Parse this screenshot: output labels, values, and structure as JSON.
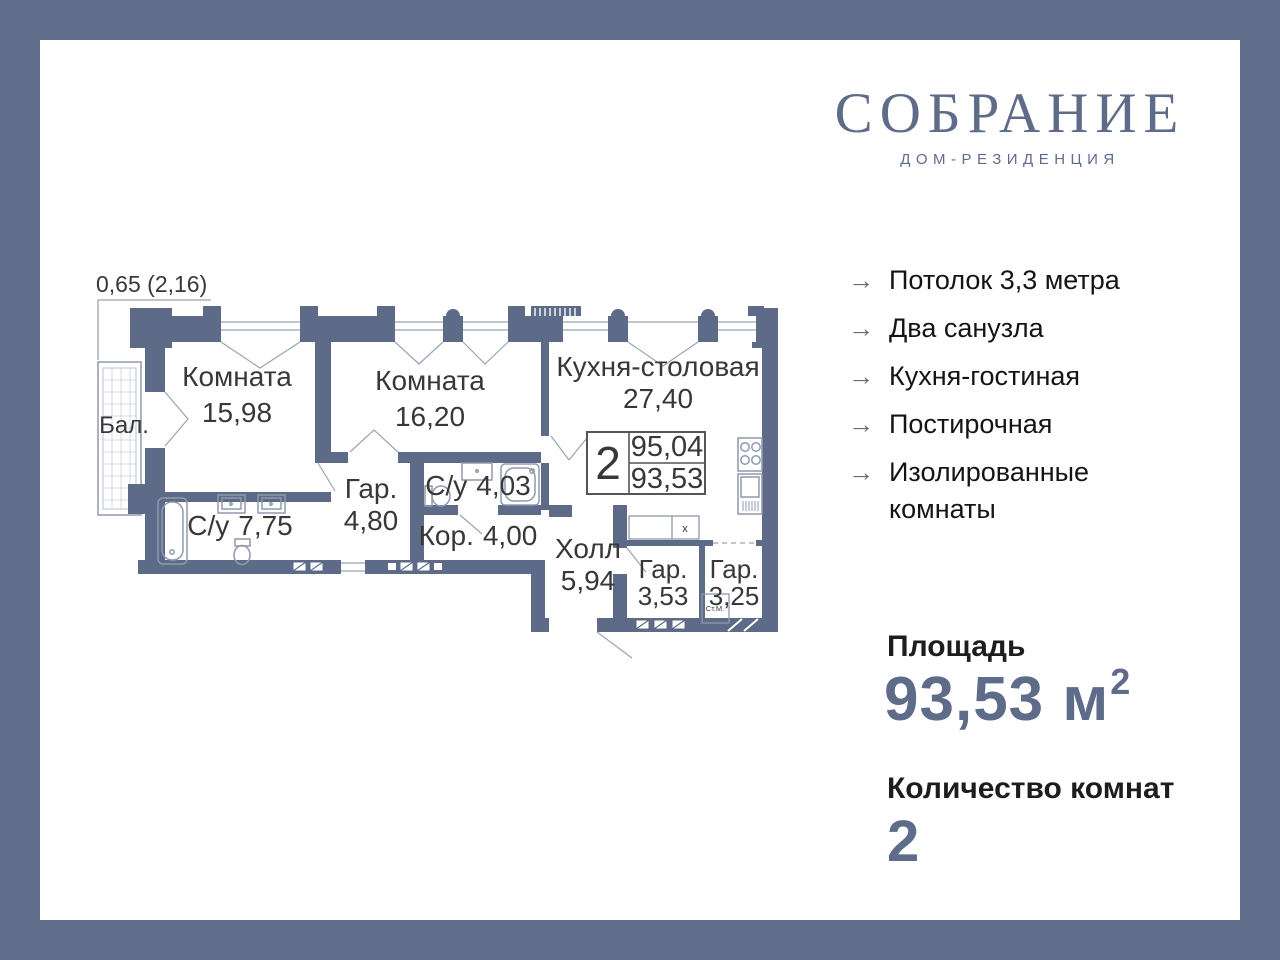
{
  "brand": {
    "name": "СОБРАНИЕ",
    "subtitle": "ДОМ-РЕЗИДЕНЦИЯ"
  },
  "colors": {
    "accent": "#5e6c8a",
    "wall": "#5d6b89",
    "thin_line": "#929cb0",
    "text_dark": "#141414"
  },
  "plan": {
    "balcony_dim": "0,65 (2,16)",
    "rooms": [
      {
        "name": "Бал.",
        "area": ""
      },
      {
        "name": "Комната",
        "area": "15,98"
      },
      {
        "name": "Комната",
        "area": "16,20"
      },
      {
        "name": "Кухня-столовая",
        "area": "27,40"
      },
      {
        "name": "С/у",
        "area": "7,75"
      },
      {
        "name": "Гар.",
        "area": "4,80"
      },
      {
        "name": "С/у",
        "area": "4,03"
      },
      {
        "name": "Кор.",
        "area": "4,00"
      },
      {
        "name": "Холл",
        "area": "5,94"
      },
      {
        "name": "Гар.",
        "area": "3,53"
      },
      {
        "name": "Гар.",
        "area": "3,25"
      }
    ],
    "info_box": {
      "rooms": "2",
      "total_area": "95,04",
      "living_area": "93,53"
    },
    "washer_label": "Ст.М.",
    "closet_mark": "х"
  },
  "features": [
    "Потолок 3,3 метра",
    "Два санузла",
    "Кухня-гостиная",
    "Постирочная",
    "Изолированные комнаты"
  ],
  "stats": {
    "area_label": "Площадь",
    "area_value": "93,53 м",
    "area_sup": "2",
    "rooms_label": "Количество комнат",
    "rooms_count": "2"
  }
}
